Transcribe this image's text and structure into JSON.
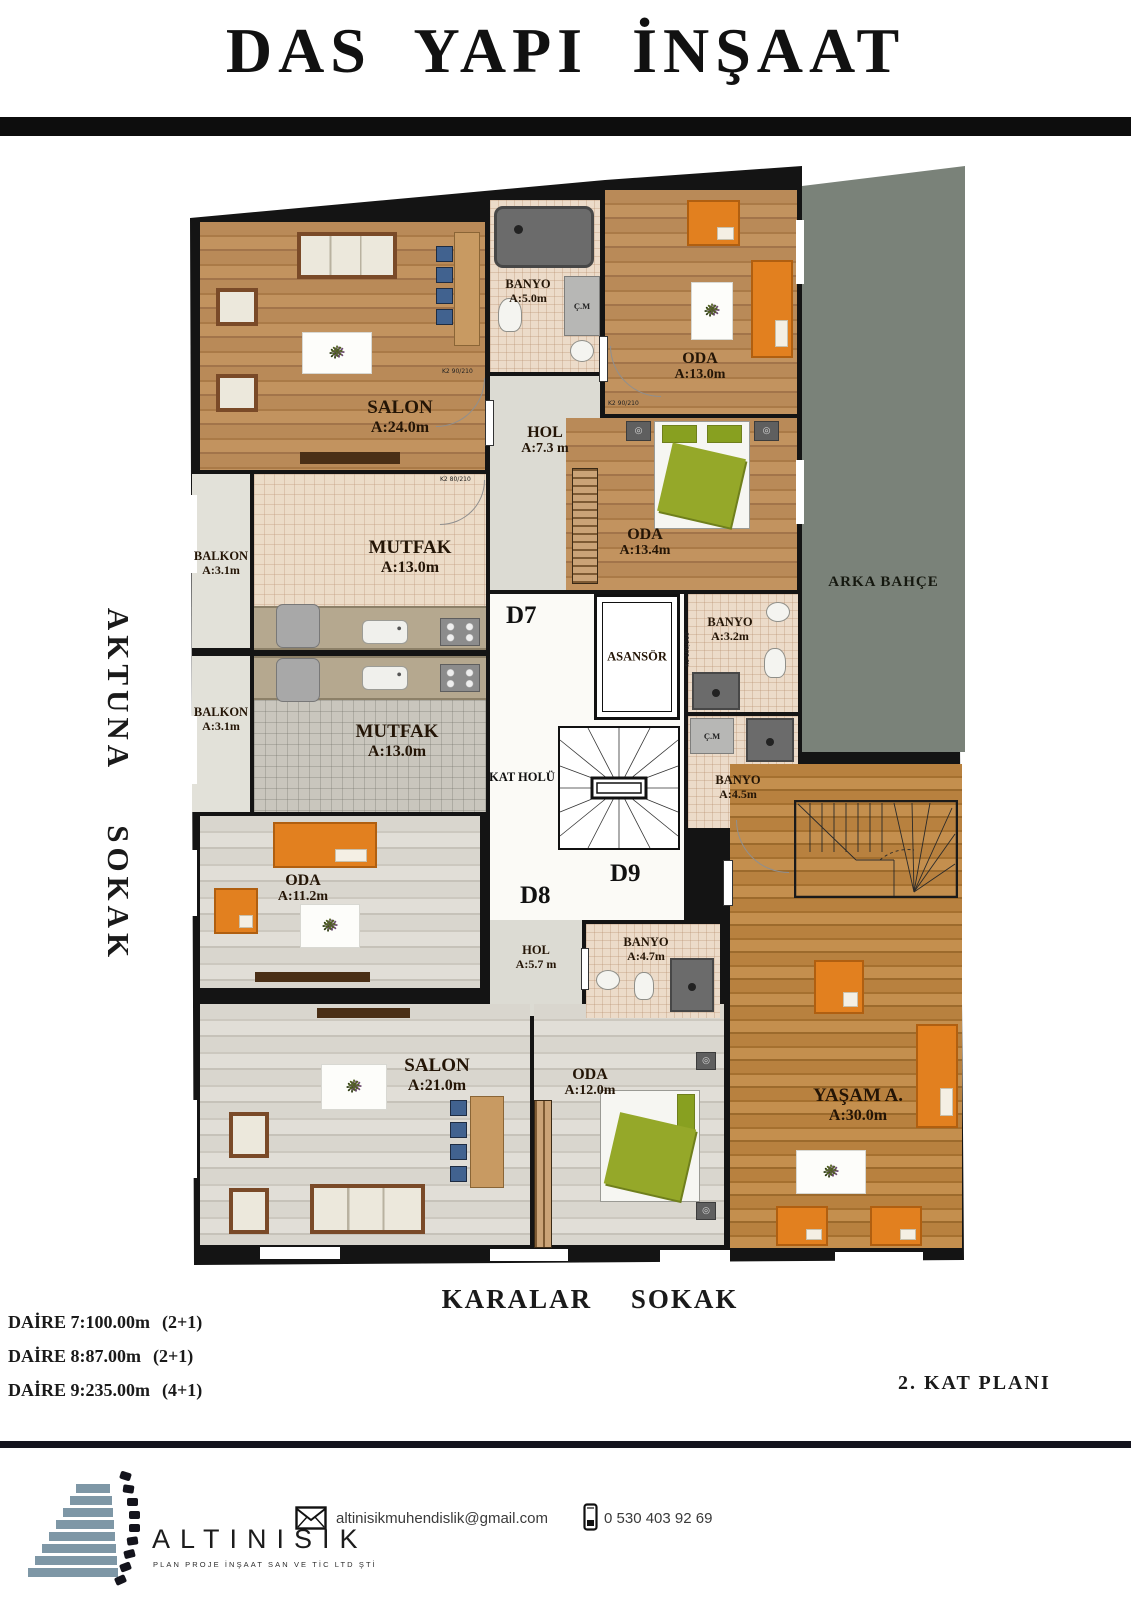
{
  "header": {
    "title": "DAS YAPI İNŞAAT"
  },
  "streets": {
    "left": "AKTUNA SOKAK",
    "bottom": "KARALAR SOKAK"
  },
  "plan": {
    "floor_label": "2. KAT PLANI",
    "labels": {
      "garden": "ARKA BAHÇE",
      "elevator": "ASANSÖR",
      "landing": "KAT HOLÜ",
      "cm": "Ç.M",
      "d7": "D7",
      "d8": "D8",
      "d9": "D9"
    },
    "door_tags": {
      "a": "K2 90/210",
      "b": "K2 80/210",
      "c": "K1 100/210"
    },
    "rooms": {
      "salon24": {
        "name": "SALON",
        "area": "A:24.0m"
      },
      "banyo5": {
        "name": "BANYO",
        "area": "A:5.0m"
      },
      "oda13": {
        "name": "ODA",
        "area": "A:13.0m"
      },
      "hol73": {
        "name": "HOL",
        "area": "A:7.3 m"
      },
      "oda134": {
        "name": "ODA",
        "area": "A:13.4m"
      },
      "banyo32": {
        "name": "BANYO",
        "area": "A:3.2m"
      },
      "mutfak_ust": {
        "name": "MUTFAK",
        "area": "A:13.0m"
      },
      "balkon_ust": {
        "name": "BALKON",
        "area": "A:3.1m"
      },
      "balkon_alt": {
        "name": "BALKON",
        "area": "A:3.1m"
      },
      "mutfak_alt": {
        "name": "MUTFAK",
        "area": "A:13.0m"
      },
      "banyo45": {
        "name": "BANYO",
        "area": "A:4.5m"
      },
      "oda112": {
        "name": "ODA",
        "area": "A:11.2m"
      },
      "hol57": {
        "name": "HOL",
        "area": "A:5.7 m"
      },
      "banyo47": {
        "name": "BANYO",
        "area": "A:4.7m"
      },
      "salon21": {
        "name": "SALON",
        "area": "A:21.0m"
      },
      "oda12": {
        "name": "ODA",
        "area": "A:12.0m"
      },
      "yasam": {
        "name": "YAŞAM A.",
        "area": "A:30.0m"
      }
    }
  },
  "apartments": [
    {
      "label": "DAİRE 7:100.00m",
      "type": "(2+1)"
    },
    {
      "label": "DAİRE 8:87.00m",
      "type": "(2+1)"
    },
    {
      "label": "DAİRE 9:235.00m",
      "type": "(4+1)"
    }
  ],
  "footer": {
    "company": "ALTINISIK",
    "tagline": "PLAN PROJE İNŞAAT SAN VE TİC LTD ŞTİ",
    "email": "altinisikmuhendislik@gmail.com",
    "phone": "0 530 403 92 69",
    "icons": {
      "email": "envelope-icon",
      "phone": "mobile-phone-icon"
    }
  },
  "colors": {
    "wall": "#141414",
    "garden_green": "#7a8279",
    "accent_orange": "#e2801f",
    "wood": "#b5854f",
    "wood_light": "#d8d5cd",
    "wood_warm": "#b07a3e",
    "logo_blue": "#7e97a6"
  }
}
